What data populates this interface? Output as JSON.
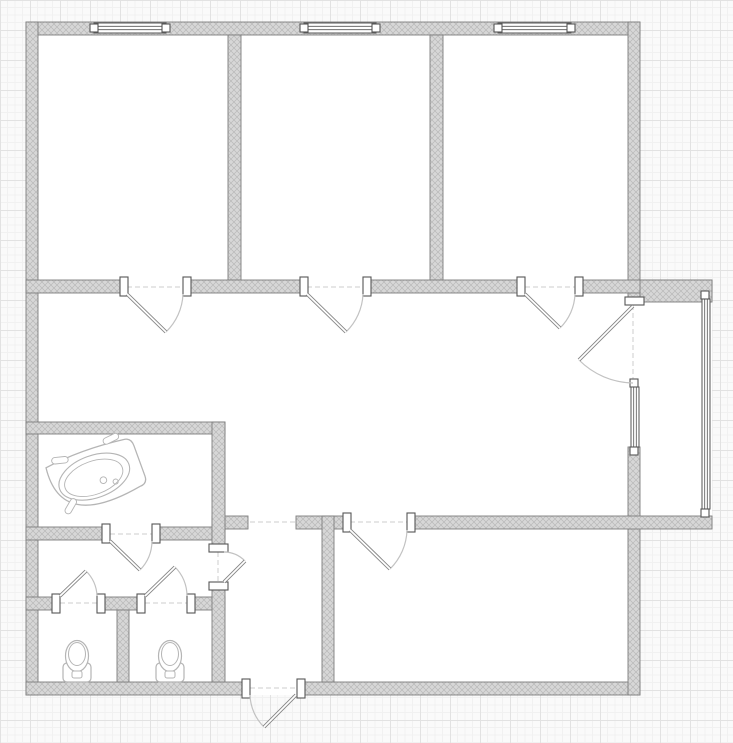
{
  "canvas": {
    "w": 733,
    "h": 743
  },
  "palette": {
    "page_bg": "#fafafa",
    "grid_minor": "#f1f1f1",
    "grid_major": "#e2e2e2",
    "interior": "#ffffff",
    "wall_fill": "#d7d7d7",
    "wall_hatch": "#b9b9b9",
    "wall_edge": "#7d7d7d",
    "frame": "#565656",
    "leaf": "#858585",
    "arc": "#c2c2c2",
    "dash": "#cccccc",
    "fixture": "#b5b5b5"
  },
  "floorplan": {
    "interior": [
      [
        26,
        22,
        614,
        673
      ],
      [
        628,
        280,
        84,
        249
      ]
    ],
    "walls": [
      [
        26,
        22,
        614,
        13
      ],
      [
        26,
        22,
        12,
        673
      ],
      [
        26,
        682,
        216,
        13
      ],
      [
        305,
        682,
        335,
        13
      ],
      [
        628,
        22,
        12,
        283
      ],
      [
        628,
        447,
        12,
        248
      ],
      [
        228,
        35,
        13,
        245
      ],
      [
        430,
        35,
        13,
        245
      ],
      [
        26,
        280,
        94,
        13
      ],
      [
        190,
        280,
        110,
        13
      ],
      [
        370,
        280,
        148,
        13
      ],
      [
        582,
        280,
        130,
        13
      ],
      [
        640,
        280,
        72,
        22
      ],
      [
        212,
        516,
        36,
        13
      ],
      [
        296,
        516,
        47,
        13
      ],
      [
        414,
        516,
        298,
        13
      ],
      [
        26,
        422,
        199,
        12
      ],
      [
        26,
        527,
        76,
        13
      ],
      [
        160,
        527,
        65,
        13
      ],
      [
        26,
        597,
        26,
        13
      ],
      [
        105,
        597,
        32,
        13
      ],
      [
        195,
        597,
        30,
        13
      ],
      [
        212,
        422,
        13,
        124
      ],
      [
        212,
        590,
        13,
        92
      ],
      [
        322,
        516,
        12,
        166
      ],
      [
        117,
        610,
        12,
        72
      ]
    ],
    "windows_h": [
      [
        94,
        23,
        72
      ],
      [
        304,
        23,
        72
      ],
      [
        498,
        23,
        73
      ]
    ],
    "windows_v": [
      [
        631,
        387,
        60
      ],
      [
        702,
        299,
        210
      ]
    ],
    "jambs_h": [
      [
        120,
        277
      ],
      [
        183,
        277
      ],
      [
        300,
        277
      ],
      [
        363,
        277
      ],
      [
        517,
        277
      ],
      [
        575,
        277
      ],
      [
        102,
        524
      ],
      [
        152,
        524
      ],
      [
        52,
        594
      ],
      [
        97,
        594
      ],
      [
        137,
        594
      ],
      [
        187,
        594
      ],
      [
        343,
        513
      ],
      [
        407,
        513
      ],
      [
        242,
        679
      ],
      [
        297,
        679
      ]
    ],
    "jambs_v": [
      [
        209,
        544
      ],
      [
        209,
        582
      ],
      [
        625,
        297
      ]
    ],
    "markers": [
      [
        90,
        24
      ],
      [
        162,
        24
      ],
      [
        300,
        24
      ],
      [
        372,
        24
      ],
      [
        494,
        24
      ],
      [
        567,
        24
      ],
      [
        630,
        379
      ],
      [
        630,
        447
      ],
      [
        701,
        291
      ],
      [
        701,
        509
      ]
    ],
    "dashes": [
      [
        127,
        287,
        183,
        287
      ],
      [
        307,
        287,
        363,
        287
      ],
      [
        525,
        287,
        575,
        287
      ],
      [
        110,
        534,
        152,
        534
      ],
      [
        60,
        603,
        97,
        603
      ],
      [
        145,
        603,
        187,
        603
      ],
      [
        250,
        522,
        296,
        522
      ],
      [
        350,
        522,
        407,
        522
      ],
      [
        250,
        688,
        297,
        688
      ],
      [
        218,
        552,
        218,
        582
      ],
      [
        633,
        305,
        633,
        383
      ]
    ],
    "doors": [
      {
        "name": "door-room1",
        "leaf": [
          127,
          294,
          166,
          332
        ],
        "arc": [
          183,
          294,
          166,
          332,
          56,
          1
        ]
      },
      {
        "name": "door-room2",
        "leaf": [
          307,
          294,
          346,
          332
        ],
        "arc": [
          363,
          294,
          346,
          332,
          56,
          1
        ]
      },
      {
        "name": "door-room3",
        "leaf": [
          525,
          294,
          560,
          328
        ],
        "arc": [
          575,
          294,
          560,
          328,
          50,
          1
        ]
      },
      {
        "name": "door-balcony",
        "leaf": [
          633,
          306,
          579,
          360
        ],
        "arc": [
          633,
          383,
          579,
          360,
          78,
          1
        ]
      },
      {
        "name": "door-bottom-room",
        "leaf": [
          350,
          530,
          390,
          569
        ],
        "arc": [
          407,
          530,
          390,
          569,
          57,
          1
        ]
      },
      {
        "name": "door-entrance",
        "leaf": [
          296,
          695,
          264,
          727
        ],
        "arc": [
          250,
          695,
          264,
          727,
          47,
          0
        ]
      },
      {
        "name": "door-bathroom",
        "leaf": [
          110,
          541,
          140,
          570
        ],
        "arc": [
          152,
          541,
          140,
          570,
          42,
          1
        ]
      },
      {
        "name": "door-wc1",
        "leaf": [
          60,
          596,
          86,
          571
        ],
        "arc": [
          97,
          596,
          86,
          571,
          37,
          0
        ]
      },
      {
        "name": "door-wc2",
        "leaf": [
          145,
          596,
          175,
          567
        ],
        "arc": [
          187,
          596,
          175,
          567,
          42,
          0
        ]
      },
      {
        "name": "door-lobby",
        "leaf": [
          224,
          582,
          245,
          561
        ],
        "arc": [
          224,
          552,
          245,
          561,
          30,
          1
        ]
      }
    ],
    "toilets": [
      {
        "cx": 77
      },
      {
        "cx": 170
      }
    ],
    "bathtub": {
      "cx": 96,
      "cy": 476,
      "rotate": -20,
      "scale": 0.92
    }
  }
}
